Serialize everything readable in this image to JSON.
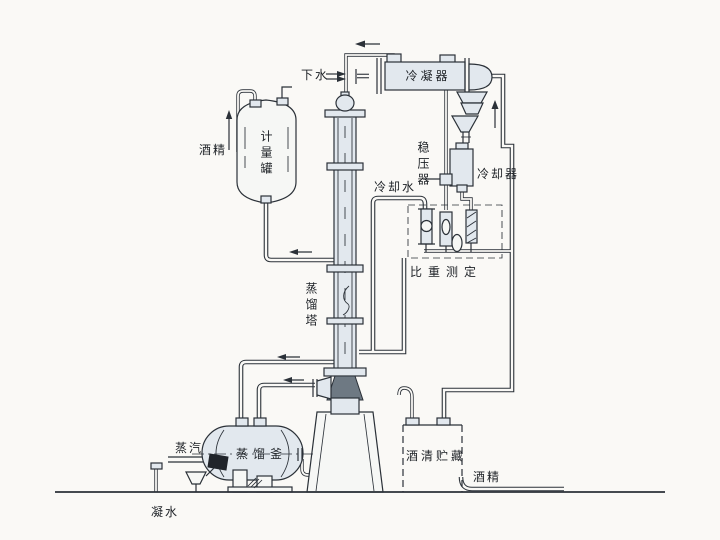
{
  "diagram": {
    "description": "alcohol-distillation-process-flow-diagram",
    "labels": {
      "drain_water": "下水",
      "condenser": "冷凝器",
      "alcohol_feed": "酒精",
      "metering_tank": "计量罐",
      "pressure_stabilizer": "稳压器",
      "cooling_water": "冷却水",
      "cooler": "冷却器",
      "gravity_measurement": "比重测定",
      "distillation_column": "蒸馏塔",
      "steam": "蒸汽",
      "distillation_kettle": "蒸馏釜",
      "condensate": "凝水",
      "alcohol_storage": "酒清贮藏",
      "alcohol_out": "酒精"
    },
    "colors": {
      "line": "#2b3138",
      "vessel_fill": "#e2e8ee",
      "dark_fill": "#6e7983",
      "background": "#faf9f6"
    }
  }
}
